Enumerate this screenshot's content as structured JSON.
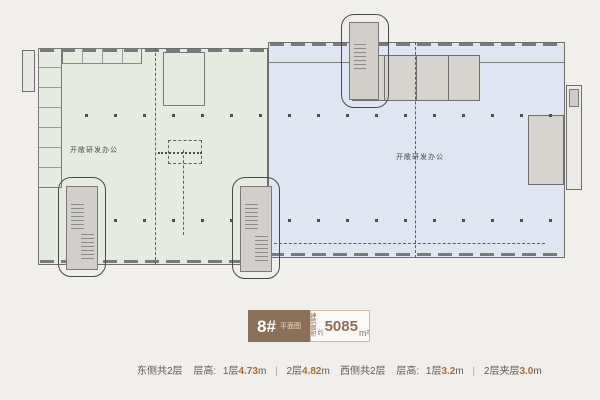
{
  "plan": {
    "east_zone_label": "开敞研发办公",
    "west_zone_label": "开敞研发办公"
  },
  "badge": {
    "building_number": "8#",
    "plan_type": "平面图",
    "area_prefix_top": "建筑",
    "area_prefix_bottom": "面积",
    "area_approx": "约",
    "area_value": "5085",
    "area_unit": "m²"
  },
  "footer": {
    "east": {
      "side": "东侧共2层",
      "height_label": "层高:",
      "f1_label": "1层",
      "f1_value": "4.73",
      "f1_unit": "m",
      "separator": "|",
      "f2_label": "2层",
      "f2_value": "4.82",
      "f2_unit": "m"
    },
    "west": {
      "side": "西侧共2层",
      "height_label": "层高:",
      "f1_label": "1层",
      "f1_value": "3.2",
      "f1_unit": "m",
      "separator": "|",
      "f2_label": "2层夹层",
      "f2_value": "3.0",
      "f2_unit": "m"
    }
  },
  "colors": {
    "accent_brown": "#8b7057",
    "highlight_orange": "#b06c2e",
    "east_fill": "#e6ebe1",
    "west_fill": "#dfe5f1",
    "background": "#f1efec"
  }
}
